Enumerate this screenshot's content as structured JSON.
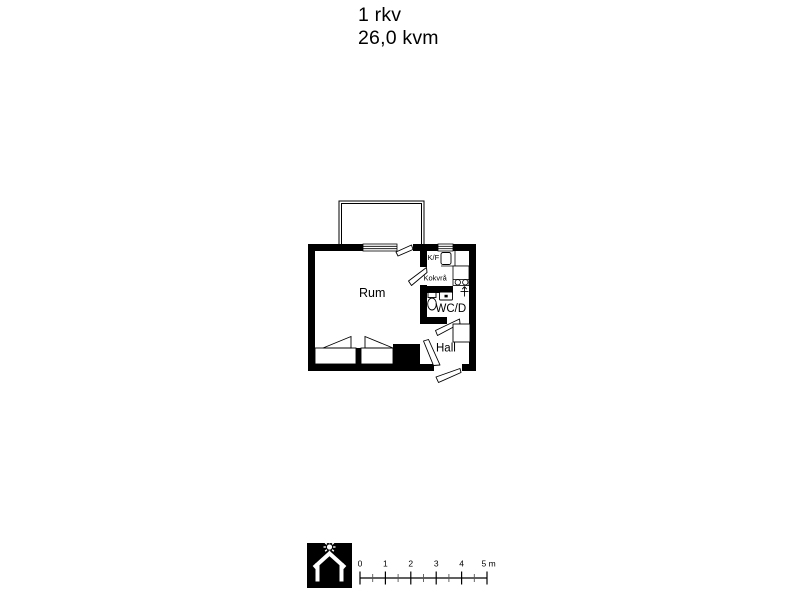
{
  "title": {
    "line1": "1 rkv",
    "line2": "26,0 kvm"
  },
  "plan": {
    "room_main": "Rum",
    "fridge_label": "K/F",
    "kitchenette": "Kokvrå",
    "bathroom": "WC/D",
    "hall": "Hall"
  },
  "scale_bar": {
    "tick0": "0",
    "tick1": "1",
    "tick2": "2",
    "tick3": "3",
    "tick4": "4",
    "tick5": "5 m"
  },
  "colors": {
    "wall": "#000000",
    "paper": "#ffffff"
  },
  "icons": {
    "logo": "house-with-sun-logo"
  }
}
